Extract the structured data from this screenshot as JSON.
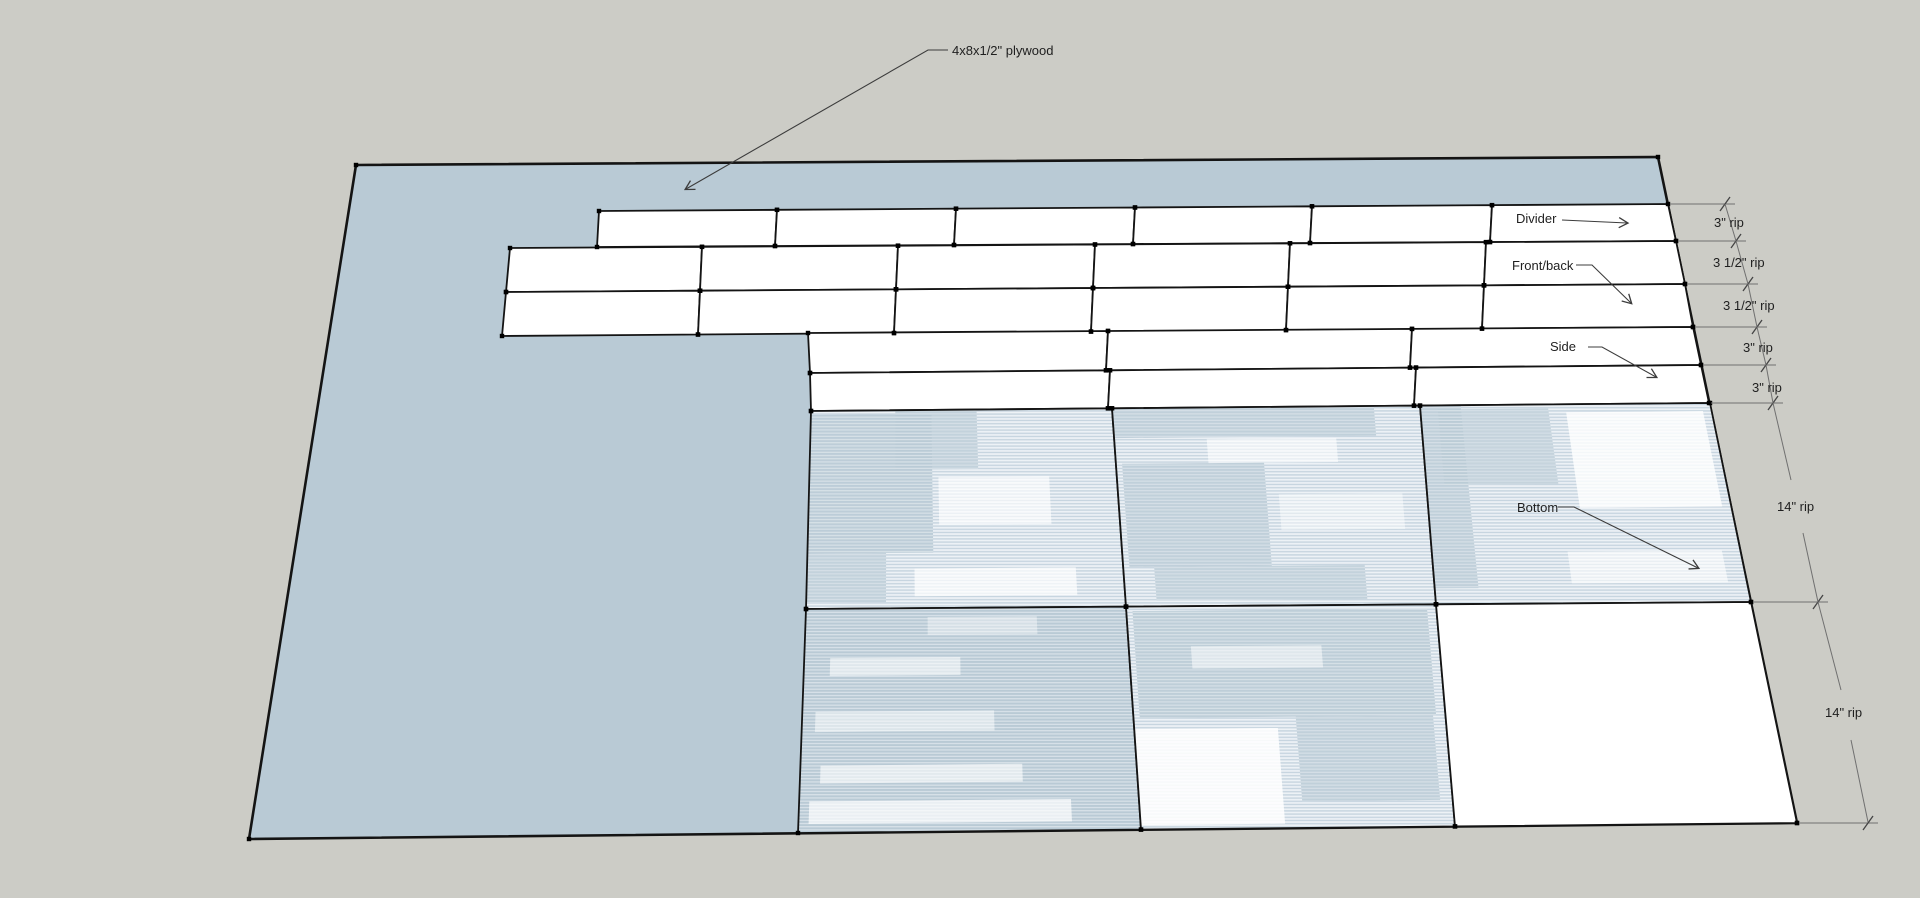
{
  "drawing": {
    "sheet_label": "4x8x1/2\" plywood",
    "piece_labels": {
      "divider": "Divider",
      "front_back": "Front/back",
      "side": "Side",
      "bottom": "Bottom"
    }
  },
  "rip_dimensions": [
    {
      "label": "3\" rip"
    },
    {
      "label": "3 1/2\" rip"
    },
    {
      "label": "3 1/2\" rip"
    },
    {
      "label": "3\" rip"
    },
    {
      "label": "3\" rip"
    },
    {
      "label": "14\" rip"
    },
    {
      "label": "14\" rip"
    }
  ],
  "cut_layout": {
    "sheet": "4x8x1/2\" plywood",
    "rows": [
      {
        "piece": "Divider",
        "rip": "3\" rip",
        "pieces_in_row": 6
      },
      {
        "piece": "Front/back",
        "rip": "3 1/2\" rip",
        "pieces_in_row": 6
      },
      {
        "piece": "Front/back",
        "rip": "3 1/2\" rip",
        "pieces_in_row": 6
      },
      {
        "piece": "Side",
        "rip": "3\" rip",
        "pieces_in_row": 3
      },
      {
        "piece": "Side",
        "rip": "3\" rip",
        "pieces_in_row": 3
      },
      {
        "piece": "Bottom",
        "rip": "14\" rip",
        "pieces_in_row": 3
      },
      {
        "piece": "Bottom",
        "rip": "14\" rip",
        "pieces_in_row": 3
      }
    ]
  },
  "colors": {
    "background": "#ccccc6",
    "sheet_blue": "#b9cad5",
    "piece_white": "#ffffff",
    "edge_black": "#141414",
    "dim_gray": "#707070",
    "leader_gray": "#3c3c3c",
    "text": "#1f1f1f",
    "texture_light_bg": "#edf2f6",
    "texture_stripe": "#c6d4df",
    "texture_blue_bg": "#b9cad5",
    "texture_blue_stripe": "#dce5eb"
  }
}
